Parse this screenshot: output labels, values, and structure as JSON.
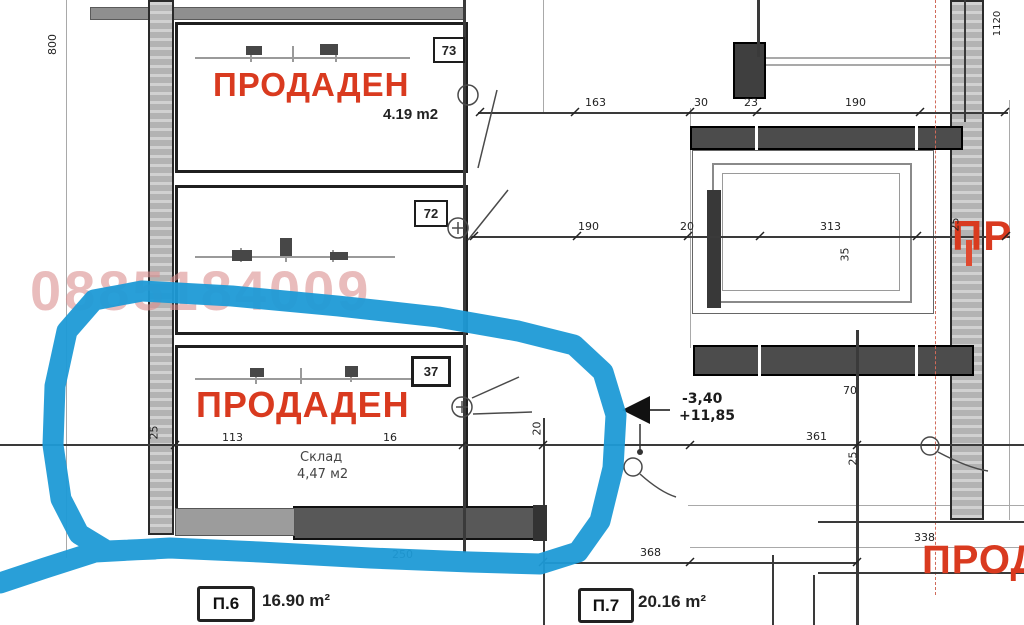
{
  "plan": {
    "watermark": "0885184009",
    "rooms": {
      "a": {
        "tag": "73",
        "status": "ПРОДАДЕН",
        "area": "4.19 m2"
      },
      "b": {
        "tag": "72"
      },
      "c": {
        "tag": "37",
        "status": "ПРОДАДЕН",
        "name": "Склад",
        "area": "4,47 м2",
        "highlighted": true
      }
    },
    "units": {
      "u1": {
        "tag": "П.6",
        "area": "16.90 m²"
      },
      "u2": {
        "tag": "П.7",
        "area": "20.16 m²"
      }
    },
    "levels": {
      "upper": "-3,40",
      "lower": "+11,85"
    },
    "partials": {
      "right": "ПР",
      "bottom": "ПРОД"
    },
    "dims": {
      "t1": "163",
      "t2": "30",
      "t3": "23",
      "t4": "190",
      "m1": "190",
      "m2": "20",
      "m3": "313",
      "m4": "35",
      "m5": "25",
      "c1": "25",
      "c2": "113",
      "c3": "16",
      "c4": "20",
      "c5": "70",
      "c6": "361",
      "c7": "25",
      "b1": "250",
      "b2": "368",
      "b3": "338",
      "left": "800",
      "topright": "1120"
    },
    "colors": {
      "sold_red": "#d93a1f",
      "watermark_pink": "#dc9090",
      "highlight_blue": "#1e9ad6",
      "wall_dark": "#4c4c4c",
      "wall_gray": "#b3b3b3"
    }
  }
}
